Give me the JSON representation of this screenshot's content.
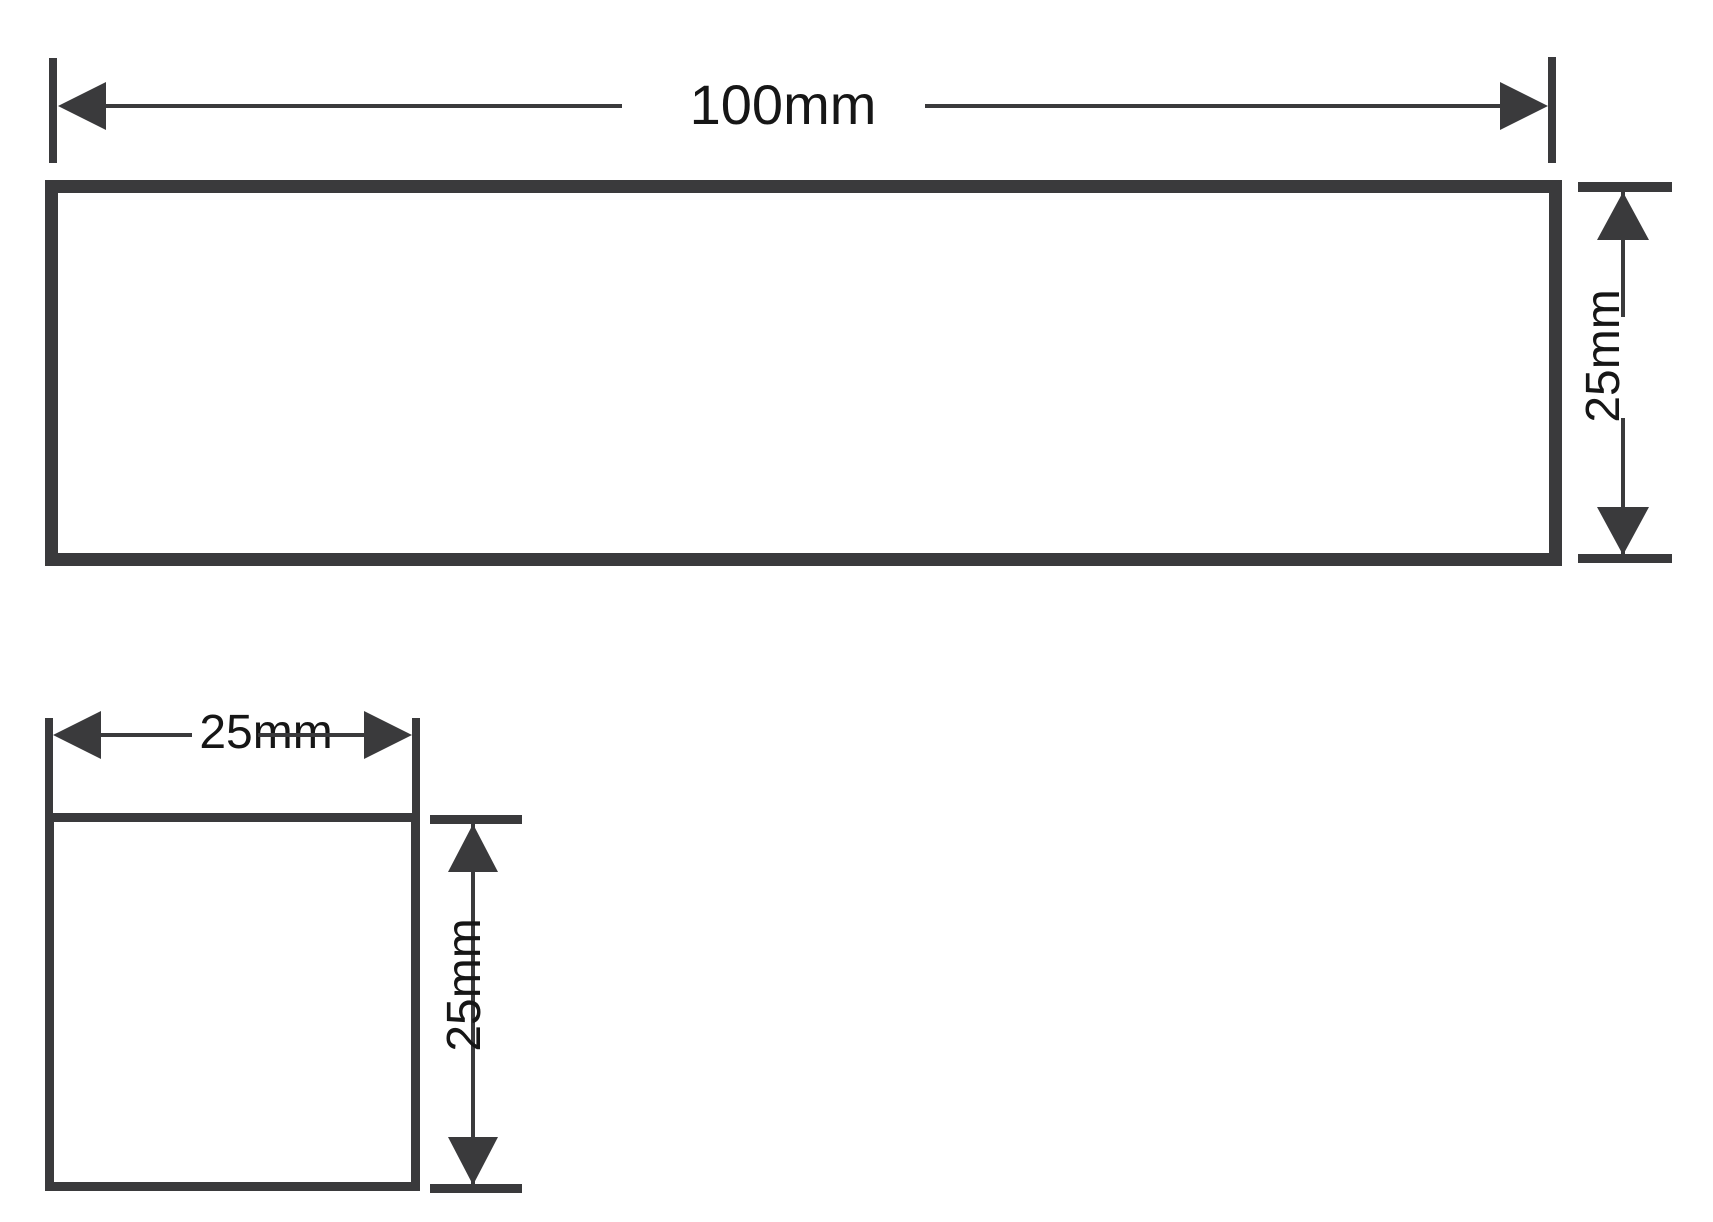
{
  "drawing": {
    "description": "Engineering dimension drawing of two shapes",
    "colors": {
      "stroke": "#3a3a3c",
      "text": "#161616",
      "background": "#ffffff"
    },
    "shapes": {
      "rectangle": {
        "name": "rectangle-100x25",
        "width_label": "100mm",
        "height_label": "25mm"
      },
      "square": {
        "name": "square-25x25",
        "width_label": "25mm",
        "height_label": "25mm"
      }
    }
  }
}
